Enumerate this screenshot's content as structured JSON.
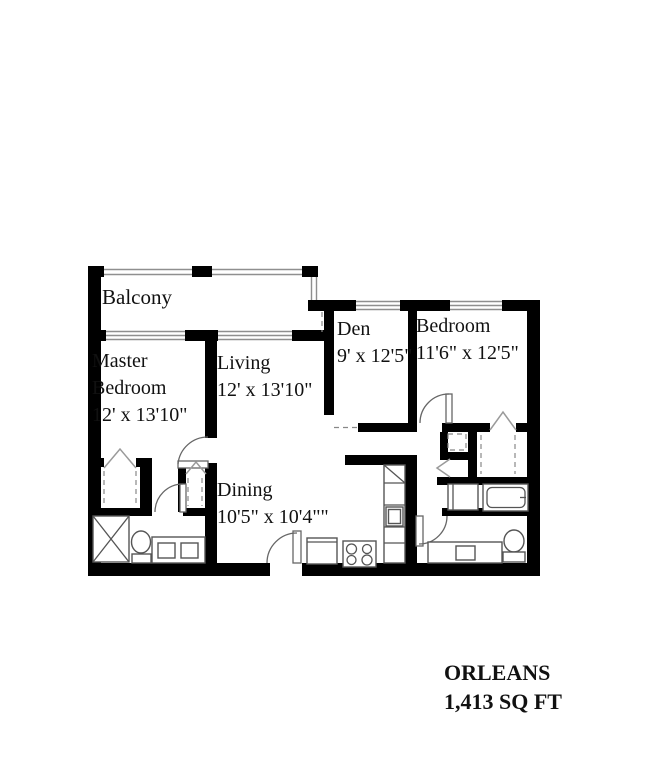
{
  "plan": {
    "rooms": {
      "balcony": {
        "label": "Balcony",
        "dims": ""
      },
      "master": {
        "label": "Master Bedroom",
        "dims": "12' x 13'10\""
      },
      "living": {
        "label": "Living",
        "dims": "12' x 13'10\""
      },
      "den": {
        "label": "Den",
        "dims": "9' x 12'5\""
      },
      "bedroom": {
        "label": "Bedroom",
        "dims": "11'6\" x 12'5\""
      },
      "dining": {
        "label": "Dining",
        "dims": "10'5\" x 10'4\"\""
      }
    },
    "title": {
      "name": "ORLEANS",
      "area": "1,413 SQ FT"
    },
    "colors": {
      "wall": "#000000",
      "line": "#555555",
      "window": "#8f8f8f",
      "background": "#ffffff",
      "text": "#111111"
    }
  }
}
